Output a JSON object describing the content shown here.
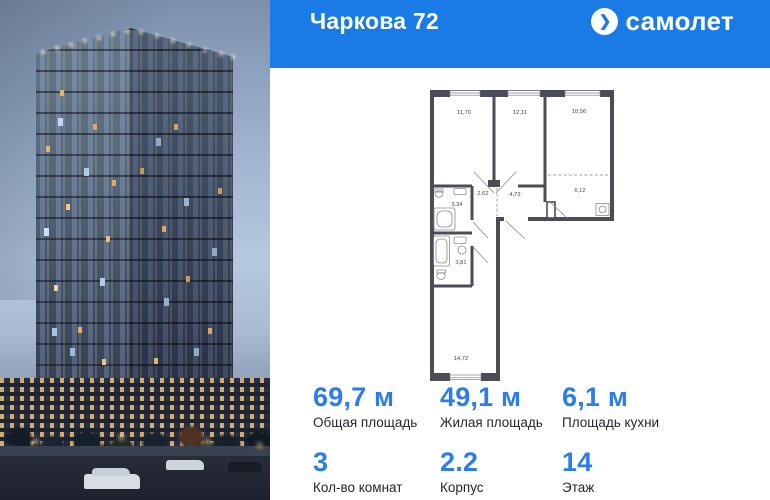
{
  "header": {
    "title": "Чаркова 72",
    "logo_text": "самолет"
  },
  "icons": {
    "logo_arrow": "❯"
  },
  "floorplan": {
    "rooms": [
      {
        "name": "room-1",
        "area": "11,70"
      },
      {
        "name": "room-2",
        "area": "12,11"
      },
      {
        "name": "room-3",
        "area": "10,56"
      },
      {
        "name": "hallway",
        "area": "2,62"
      },
      {
        "name": "corridor",
        "area": "4,73"
      },
      {
        "name": "kitchen",
        "area": "6,12"
      },
      {
        "name": "bathroom-1",
        "area": "3,34"
      },
      {
        "name": "bathroom-2",
        "area": "3,81"
      },
      {
        "name": "room-4",
        "area": "14,72"
      }
    ]
  },
  "stats": {
    "row1": [
      {
        "value": "69,7 м",
        "label": "Общая площадь"
      },
      {
        "value": "49,1 м",
        "label": "Жилая площадь"
      },
      {
        "value": "6,1 м",
        "label": "Площадь кухни"
      }
    ],
    "row2": [
      {
        "value": "3",
        "label": "Кол-во комнат"
      },
      {
        "value": "2.2",
        "label": "Корпус"
      },
      {
        "value": "14",
        "label": "Этаж"
      }
    ]
  },
  "colors": {
    "header_bg": "#1a7ae6",
    "accent": "#2b7de9",
    "plan_wall": "#4b4c55"
  }
}
